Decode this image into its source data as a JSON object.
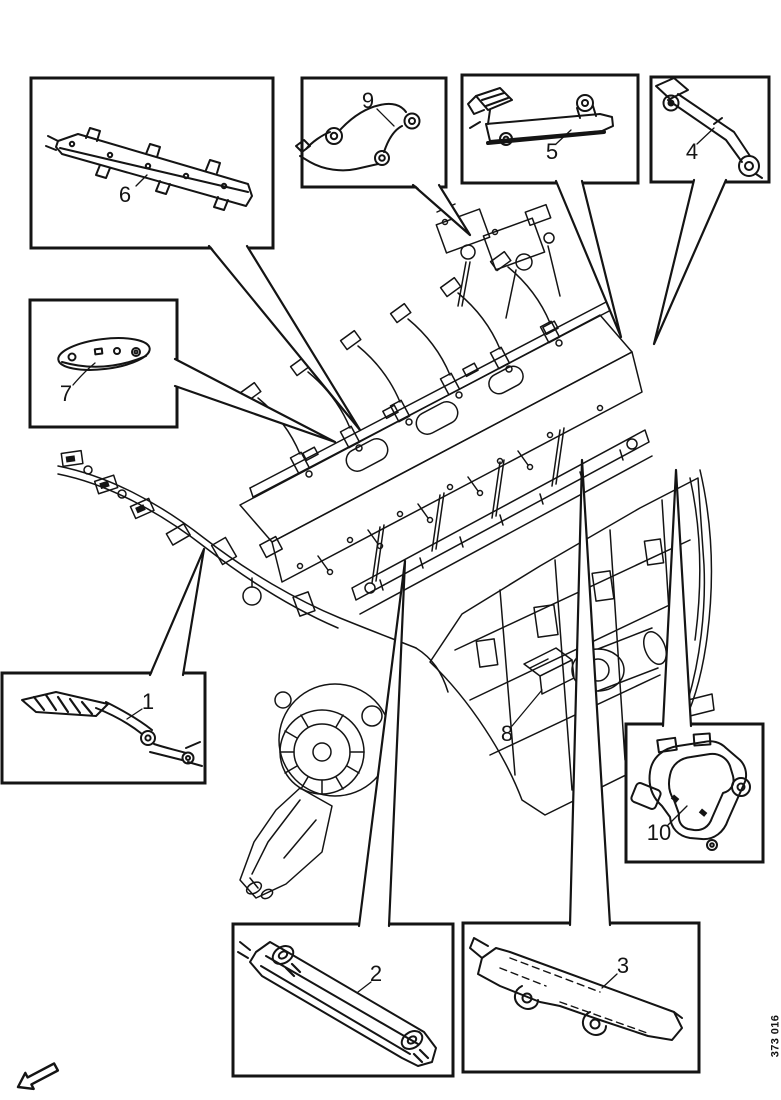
{
  "page": {
    "background_color": "#ffffff",
    "ink_color": "#141414"
  },
  "diagram": {
    "description_visible_text_only": "",
    "callouts": {
      "c1": {
        "label": "1"
      },
      "c2": {
        "label": "2"
      },
      "c3": {
        "label": "3"
      },
      "c4": {
        "label": "4"
      },
      "c5": {
        "label": "5"
      },
      "c6": {
        "label": "6"
      },
      "c7": {
        "label": "7"
      },
      "c8": {
        "label": "8"
      },
      "c9": {
        "label": "9"
      },
      "c10": {
        "label": "10"
      }
    },
    "figure_code": "373 016",
    "icons": {
      "orientation_arrow": "direction-arrow-icon"
    }
  }
}
